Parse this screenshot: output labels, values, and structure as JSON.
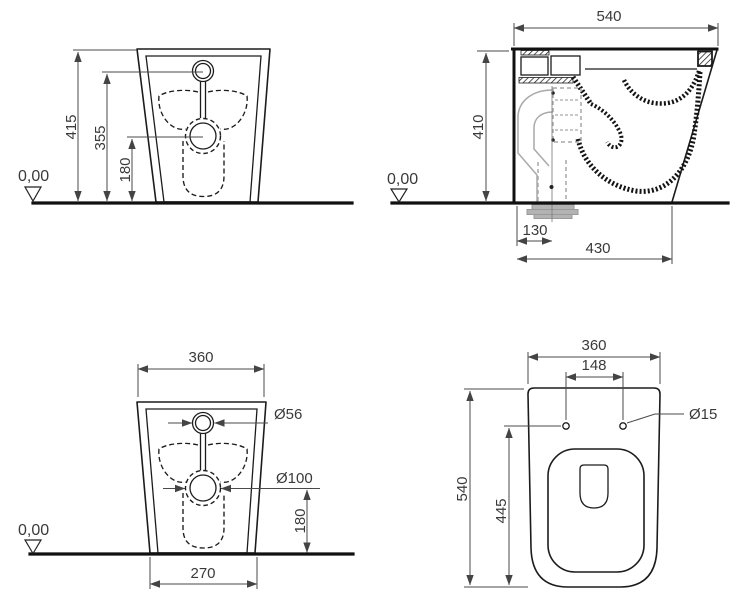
{
  "views": {
    "front_upper": {
      "total_height": "415",
      "inlet_height": "355",
      "drain_height": "180",
      "datum": "0,00"
    },
    "side": {
      "depth": "540",
      "height": "410",
      "outlet_offset": "130",
      "base_depth": "430",
      "datum": "0,00"
    },
    "front_lower": {
      "width": "360",
      "inlet_diameter": "Ø56",
      "drain_diameter": "Ø100",
      "drain_height": "180",
      "base_width": "270",
      "datum": "0,00"
    },
    "plan": {
      "width": "360",
      "hole_spacing": "148",
      "hole_diameter": "Ø15",
      "depth": "540",
      "hole_offset": "445"
    }
  },
  "colors": {
    "line": "#1c1c1c",
    "dimension": "#4a4a4a",
    "ghost_pipe": "#a9a9a9",
    "background": "#ffffff"
  }
}
